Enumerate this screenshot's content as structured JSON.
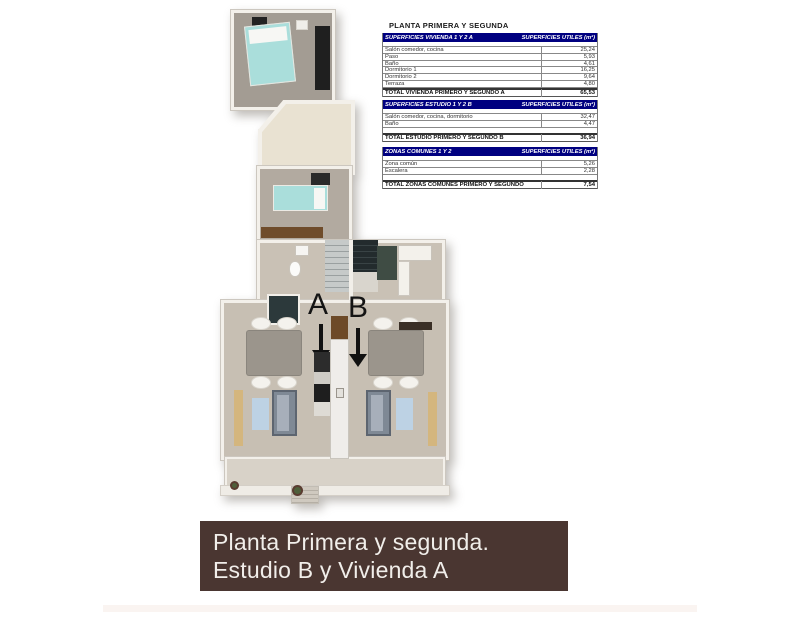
{
  "title": "PLANTA PRIMERA Y SEGUNDA",
  "tables": [
    {
      "header_left": "SUPERFICIES VIVIENDA 1 Y 2 A",
      "header_right": "SUPERFICIES UTILES  (m²)",
      "rows": [
        {
          "label": "Salón comedor, cocina",
          "value": "25,24"
        },
        {
          "label": "Paso",
          "value": "5,93"
        },
        {
          "label": "Baño",
          "value": "4,61"
        },
        {
          "label": "Dormitorio 1",
          "value": "16,25"
        },
        {
          "label": "Dormitorio 2",
          "value": "9,64"
        },
        {
          "label": "Terraza",
          "value": "4,80"
        }
      ],
      "total_label": "TOTAL VIVIENDA PRIMERO Y SEGUNDO A",
      "total_value": "65,53"
    },
    {
      "header_left": "SUPERFICIES ESTUDIO 1 Y 2 B",
      "header_right": "SUPERFICIES UTILES  (m²)",
      "rows": [
        {
          "label": "Salón comedor, cocina, dormitorio",
          "value": "32,47"
        },
        {
          "label": "Baño",
          "value": "4,47"
        }
      ],
      "total_label": "TOTAL ESTUDIO PRIMERO Y SEGUNDO B",
      "total_value": "36,94"
    },
    {
      "header_left": "ZONAS COMUNES 1 Y 2",
      "header_right": "SUPERFICIES UTILES  (m²)",
      "rows": [
        {
          "label": "Zona común",
          "value": "5,26"
        },
        {
          "label": "Escalera",
          "value": "2,28"
        }
      ],
      "total_label": "TOTAL ZONAS COMUNES PRIMERO Y SEGUNDO",
      "total_value": "7,54"
    }
  ],
  "plan": {
    "unit_a_label": "A",
    "unit_b_label": "B"
  },
  "banner": {
    "line1": "Planta Primera y segunda.",
    "line2": "Estudio B y Vivienda A"
  },
  "colors": {
    "table_header_bg": "#000080",
    "banner_bg": "#4a3631"
  }
}
